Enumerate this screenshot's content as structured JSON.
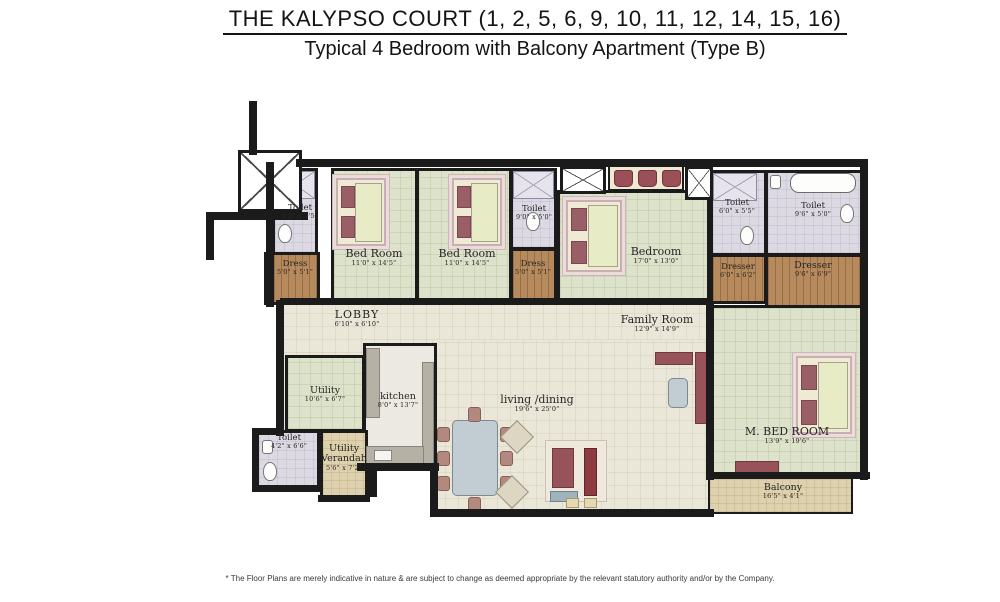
{
  "header": {
    "title": "THE KALYPSO COURT (1, 2, 5, 6, 9, 10, 11, 12, 14, 15, 16)",
    "subtitle": "Typical 4 Bedroom with Balcony Apartment (Type B)"
  },
  "footer": {
    "disclaimer": "* The Floor Plans are merely indicative in nature & are subject to change as deemed appropriate by the relevant statutory authority and/or by the Company."
  },
  "rooms": [
    {
      "id": "toilet-1",
      "name": "Toilet",
      "dims": "9'0\" x 5'5\""
    },
    {
      "id": "dress-1",
      "name": "Dress",
      "dims": "5'0\" x 5'1\""
    },
    {
      "id": "bedroom-1",
      "name": "Bed Room",
      "dims": "11'0\" x 14'5\""
    },
    {
      "id": "bedroom-2",
      "name": "Bed Room",
      "dims": "11'0\" x 14'5\""
    },
    {
      "id": "toilet-2",
      "name": "Toilet",
      "dims": "9'0\" x 5'0\""
    },
    {
      "id": "dress-2",
      "name": "Dress",
      "dims": "5'0\" x 5'1\""
    },
    {
      "id": "bedroom-3",
      "name": "Bedroom",
      "dims": "17'0\" x 13'0\""
    },
    {
      "id": "toilet-3",
      "name": "Toilet",
      "dims": "6'0\" x 5'5\""
    },
    {
      "id": "toilet-4",
      "name": "Toilet",
      "dims": "9'6\" x 5'0\""
    },
    {
      "id": "dresser-1",
      "name": "Dresser",
      "dims": "6'0\" x 6'2\""
    },
    {
      "id": "dresser-2",
      "name": "Dresser",
      "dims": "9'6\" x 6'9\""
    },
    {
      "id": "lobby",
      "name": "LOBBY",
      "dims": "6'10\" x 6'10\""
    },
    {
      "id": "family-room",
      "name": "Family Room",
      "dims": "12'9\" x 14'9\""
    },
    {
      "id": "utility",
      "name": "Utility",
      "dims": "10'6\" x 6'7\""
    },
    {
      "id": "kitchen",
      "name": "kitchen",
      "dims": "8'0\" x 13'7\""
    },
    {
      "id": "toilet-5",
      "name": "Toilet",
      "dims": "4'2\" x 6'6\""
    },
    {
      "id": "utility-verandah",
      "name": "Utility Verandah",
      "dims": "5'6\" x 7'2\""
    },
    {
      "id": "living-dining",
      "name": "living /dining",
      "dims": "19'6\" x 25'0\""
    },
    {
      "id": "m-bedroom",
      "name": "M. BED ROOM",
      "dims": "13'9\" x 19'6\""
    },
    {
      "id": "balcony",
      "name": "Balcony",
      "dims": "16'5\" x 4'1\""
    }
  ],
  "palette": {
    "wall": "#1b1b1b",
    "bedroom_floor": "#dde2cb",
    "living_floor": "#eae7d8",
    "toilet_floor": "#dcd9e3",
    "wood_floor": "#b68a5c",
    "balcony_floor": "#ddd1ae",
    "furniture_accent": "#9a5f66"
  },
  "icons": {
    "stairs": "x-crossed-box",
    "lift": "x-crossed-box",
    "shower": "x-crossed-tile",
    "bed": "rect-with-pillows",
    "wardrobe": "strip-with-clothes",
    "dining-table": "rounded-rect-with-chairs",
    "sofa": "maroon-block",
    "wc": "oval",
    "bathtub": "rounded-rect",
    "basin": "small-rect"
  }
}
